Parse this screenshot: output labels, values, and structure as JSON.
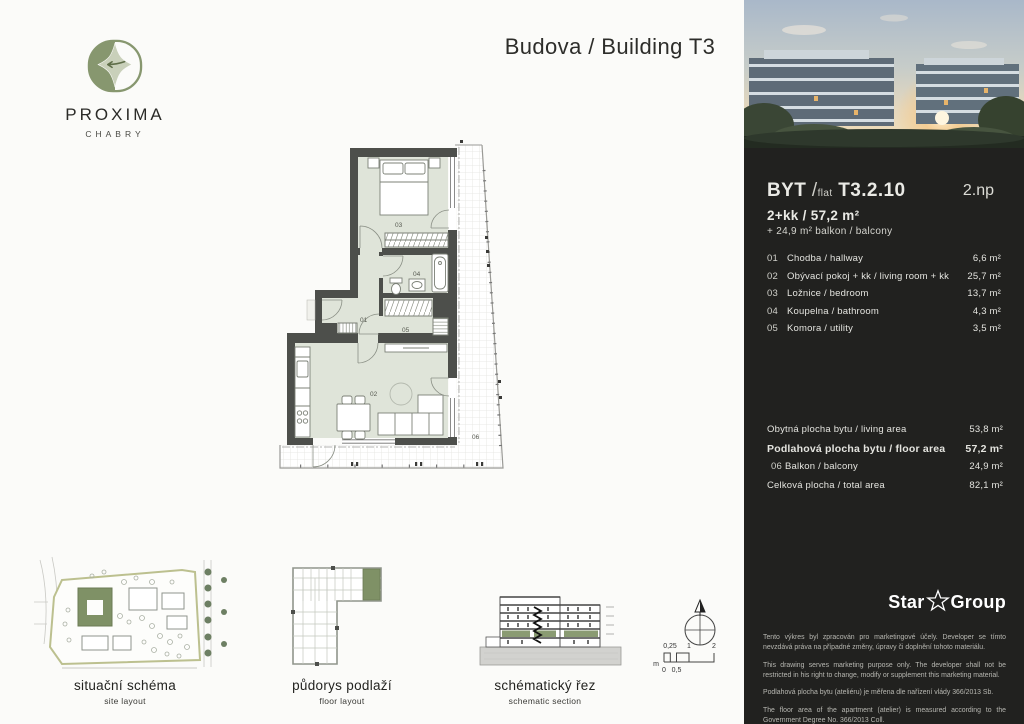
{
  "brand": {
    "name": "PROXIMA",
    "sub": "CHABRY"
  },
  "page": {
    "title": "Budova / Building T3"
  },
  "unit": {
    "byt_label": "BYT",
    "flat_label": "flat",
    "slash": "/",
    "code": "T3.2.10",
    "floor": "2.np",
    "disposition": "2+kk / 57,2 m²",
    "balcony_note": "+ 24,9 m² balkon / balcony",
    "rooms": [
      {
        "num": "01",
        "name": "Chodba / hallway",
        "area": "6,6 m²"
      },
      {
        "num": "02",
        "name": "Obývací pokoj + kk / living room + kk",
        "area": "25,7 m²"
      },
      {
        "num": "03",
        "name": "Ložnice / bedroom",
        "area": "13,7 m²"
      },
      {
        "num": "04",
        "name": "Koupelna / bathroom",
        "area": "4,3 m²"
      },
      {
        "num": "05",
        "name": "Komora / utility",
        "area": "3,5 m²"
      }
    ],
    "summary": [
      {
        "num": "",
        "label": "Obytná plocha bytu / living area",
        "value": "53,8 m²"
      },
      {
        "num": "",
        "label": "Podlahová plocha bytu / floor area",
        "value": "57,2 m²"
      },
      {
        "num": "06",
        "label": "Balkon / balcony",
        "value": "24,9 m²"
      },
      {
        "num": "",
        "label": "Celková plocha / total area",
        "value": "82,1 m²"
      }
    ]
  },
  "plan_labels": {
    "r01": "01",
    "r02": "02",
    "r03": "03",
    "r04": "04",
    "r05": "05",
    "r06": "06"
  },
  "developer": {
    "star": "Star",
    "group": "Group"
  },
  "legal": {
    "p1": "Tento výkres byl zpracován pro marketingové účely. Developer se tímto nevzdává práva na případné změny, úpravy či doplnění tohoto materiálu.",
    "p2": "This drawing serves marketing purpose only. The developer shall not be restricted in his right to change, modify or supplement this marketing material.",
    "p3": "Podlahová plocha bytu (ateliéru) je měřena dle nařízení vlády 366/2013 Sb.",
    "p4": "The floor area of the apartment (atelier) is measured according to the Government Degree No. 366/2013 Coll."
  },
  "diagrams": {
    "site": {
      "title": "situační schéma",
      "subtitle": "site layout"
    },
    "floor": {
      "title": "půdorys podlaží",
      "subtitle": "floor layout"
    },
    "section": {
      "title": "schématický řez",
      "subtitle": "schematic section"
    }
  },
  "scalebar": {
    "unit": "m",
    "t1": "0,25",
    "t2": "1",
    "t3": "2",
    "b1": "0",
    "b2": "0,5"
  },
  "colors": {
    "accent_green": "#7f9166",
    "room_fill": "#dfe4d9",
    "wall": "#4d4f4b",
    "sidebar_bg": "#21211f"
  }
}
